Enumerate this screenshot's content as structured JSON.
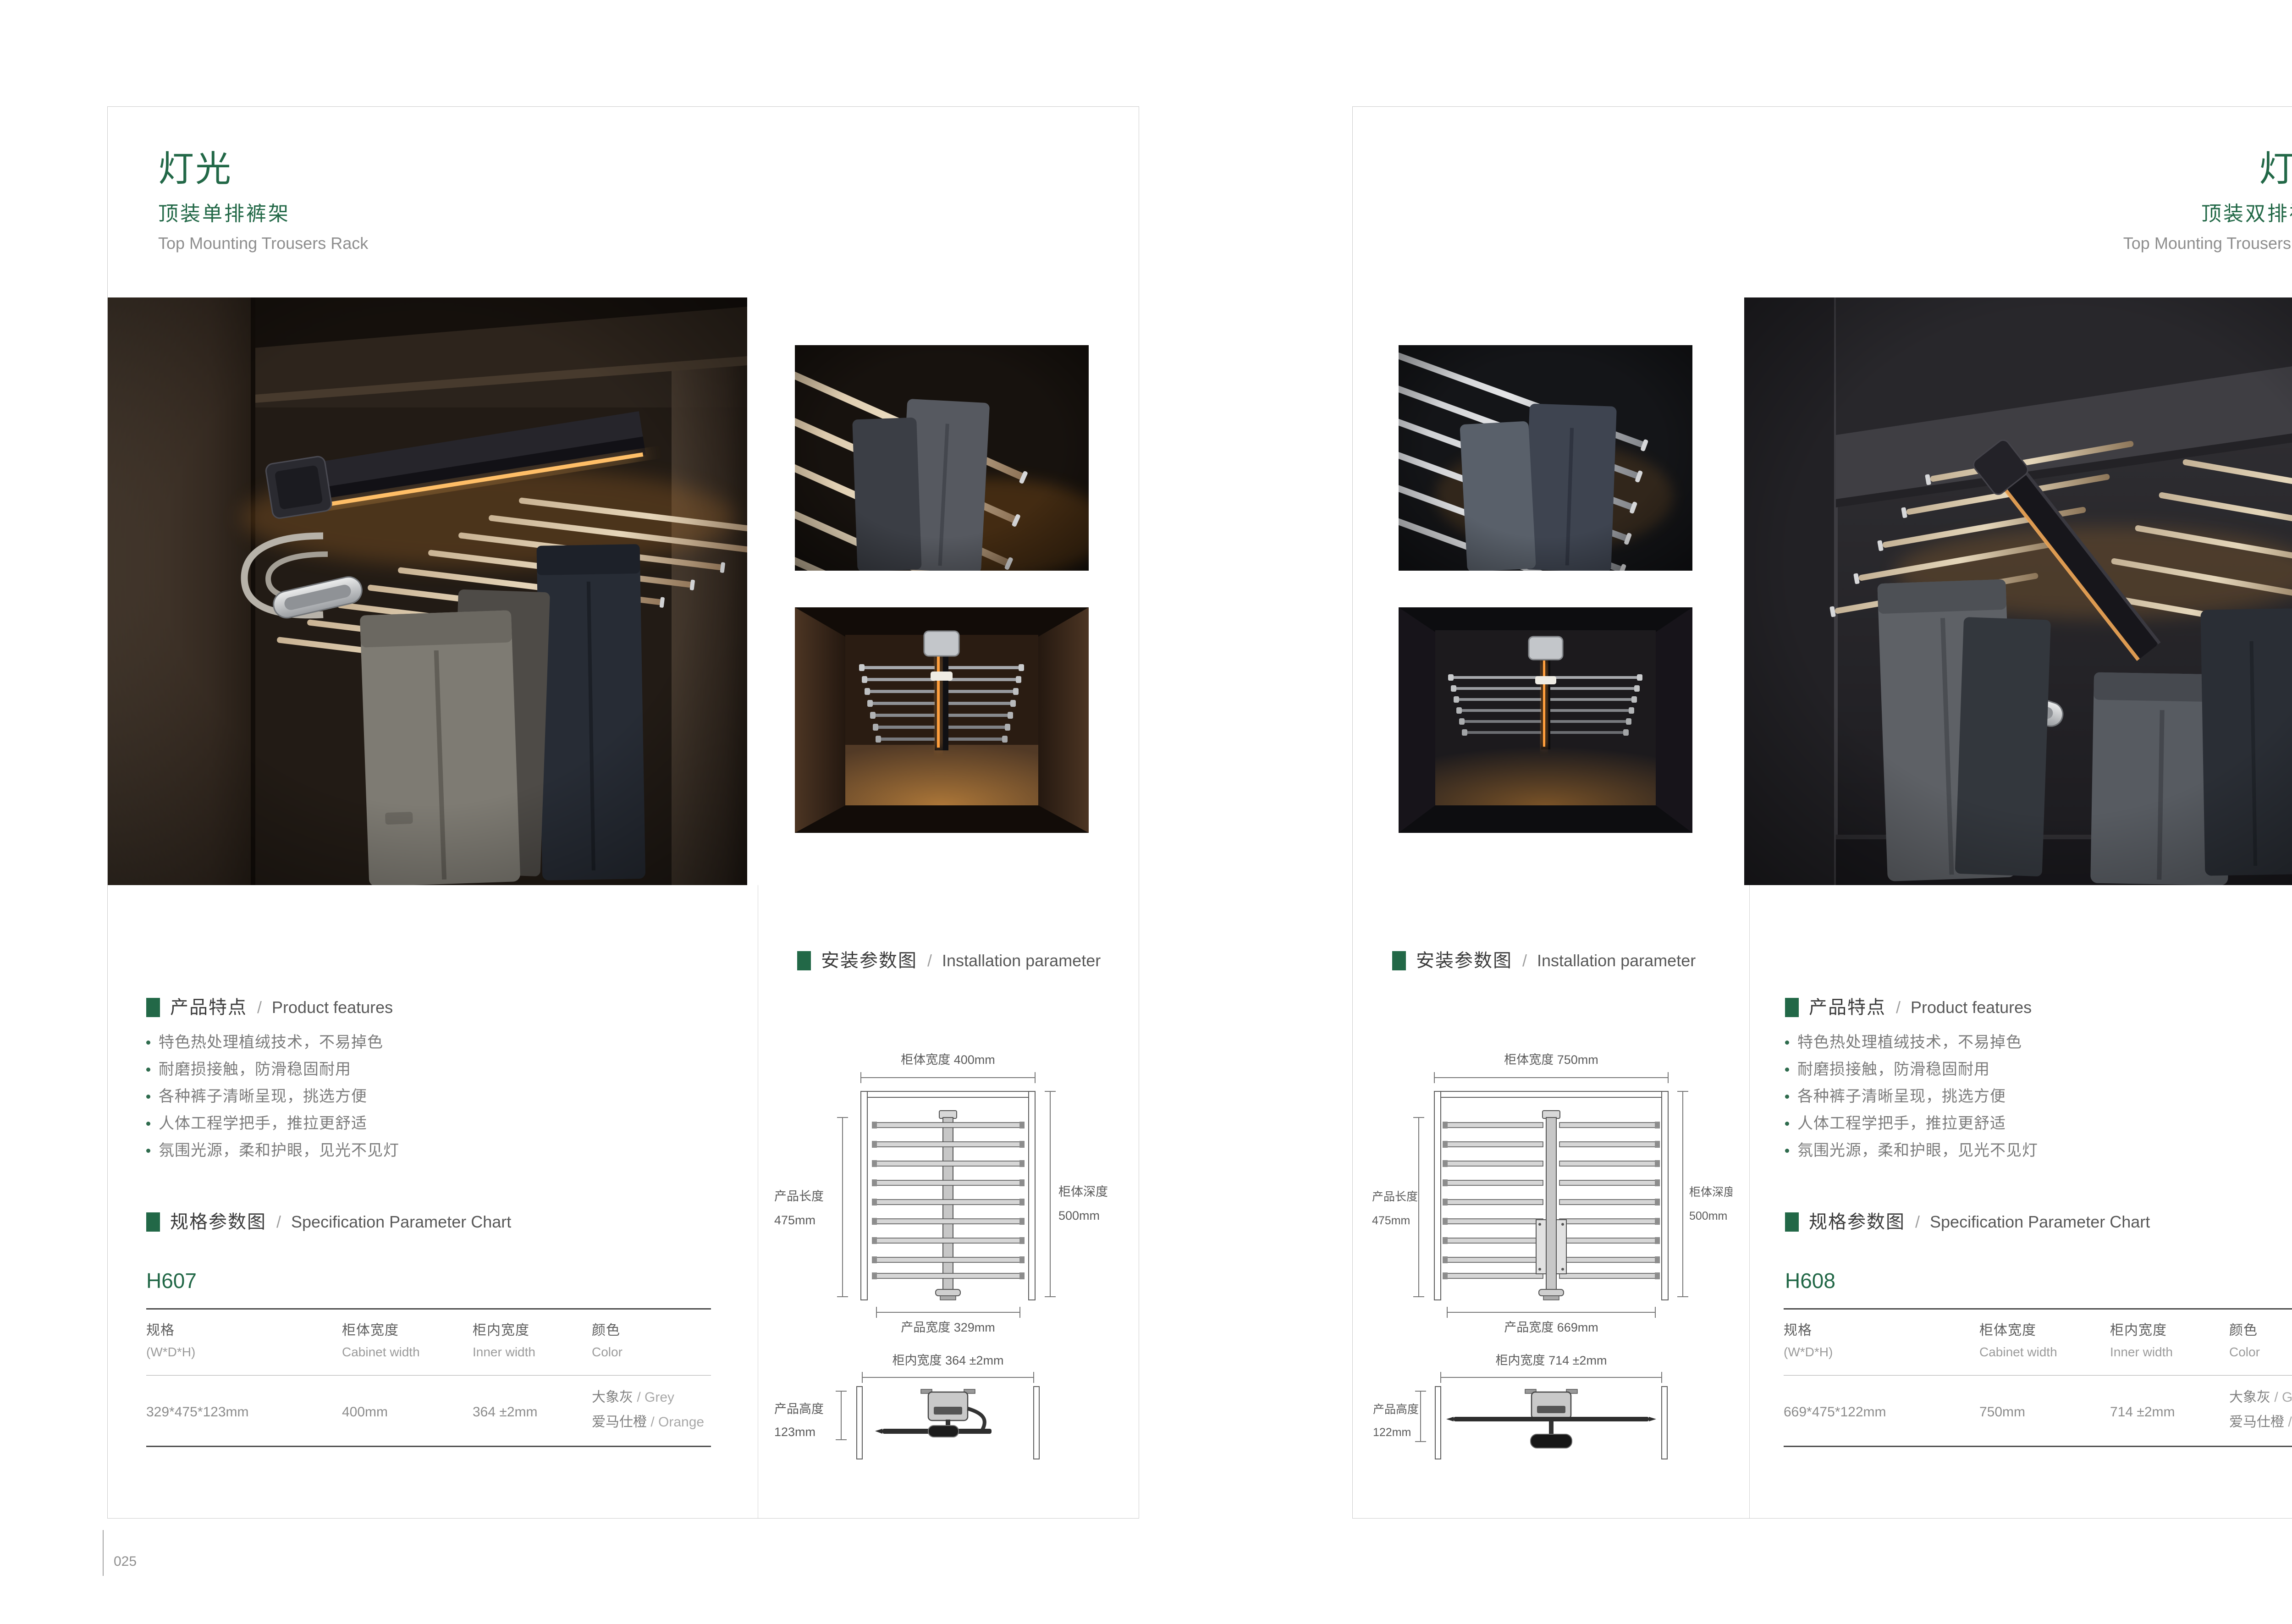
{
  "colors": {
    "accent_green": "#226847",
    "subtitle_gray": "#8e8e8e",
    "table_rule_dark": "#4a4a4a",
    "body_text_gray": "#7c7c7c"
  },
  "left_page": {
    "page_number": "025",
    "header": {
      "title": "灯光",
      "subtitle_cn": "顶装单排裤架",
      "subtitle_en": "Top Mounting Trousers Rack"
    },
    "features": {
      "cn": "产品特点",
      "sep": "/",
      "en": "Product features",
      "items": [
        "特色热处理植绒技术，不易掉色",
        "耐磨损接触，防滑稳固耐用",
        "各种裤子清晰呈现，挑选方便",
        "人体工程学把手，推拉更舒适",
        "氛围光源，柔和护眼，见光不见灯"
      ]
    },
    "installation": {
      "cn": "安装参数图",
      "sep": "/",
      "en": "Installation parameter",
      "top": {
        "cabinet_width": "柜体宽度 400mm",
        "product_length_1": "产品长度",
        "product_length_2": "475mm",
        "cabinet_depth_1": "柜体深度",
        "cabinet_depth_2": "500mm",
        "product_width": "产品宽度 329mm"
      },
      "bottom": {
        "inner_width": "柜内宽度 364 ±2mm",
        "product_height_1": "产品高度",
        "product_height_2": "123mm"
      }
    },
    "spec": {
      "cn": "规格参数图",
      "sep": "/",
      "en": "Specification Parameter Chart",
      "model": "H607",
      "col1_cn": "规格",
      "col1_en": "(W*D*H)",
      "col2_cn": "柜体宽度",
      "col2_en": "Cabinet width",
      "col3_cn": "柜内宽度",
      "col3_en": "Inner width",
      "col4_cn": "颜色",
      "col4_en": "Color",
      "val_size": "329*475*123mm",
      "val_cabinet_width": "400mm",
      "val_inner_width": "364 ±2mm",
      "color1_cn": "大象灰",
      "color1_en": "/ Grey",
      "color2_cn": "爱马仕橙",
      "color2_en": "/ Orange"
    }
  },
  "right_page": {
    "page_number": "026",
    "header": {
      "title": "灯光",
      "subtitle_cn": "顶装双排裤架",
      "subtitle_en": "Top Mounting Trousers Rack"
    },
    "features": {
      "cn": "产品特点",
      "sep": "/",
      "en": "Product features",
      "items": [
        "特色热处理植绒技术，不易掉色",
        "耐磨损接触，防滑稳固耐用",
        "各种裤子清晰呈现，挑选方便",
        "人体工程学把手，推拉更舒适",
        "氛围光源，柔和护眼，见光不见灯"
      ]
    },
    "installation": {
      "cn": "安装参数图",
      "sep": "/",
      "en": "Installation parameter",
      "top": {
        "cabinet_width": "柜体宽度 750mm",
        "product_length_1": "产品长度",
        "product_length_2": "475mm",
        "cabinet_depth_1": "柜体深度",
        "cabinet_depth_2": "500mm",
        "product_width": "产品宽度 669mm"
      },
      "bottom": {
        "inner_width": "柜内宽度 714 ±2mm",
        "product_height_1": "产品高度",
        "product_height_2": "122mm"
      }
    },
    "spec": {
      "cn": "规格参数图",
      "sep": "/",
      "en": "Specification Parameter Chart",
      "model": "H608",
      "col1_cn": "规格",
      "col1_en": "(W*D*H)",
      "col2_cn": "柜体宽度",
      "col2_en": "Cabinet width",
      "col3_cn": "柜内宽度",
      "col3_en": "Inner width",
      "col4_cn": "颜色",
      "col4_en": "Color",
      "val_size": "669*475*122mm",
      "val_cabinet_width": "750mm",
      "val_inner_width": "714 ±2mm",
      "color1_cn": "大象灰",
      "color1_en": "/ Grey",
      "color2_cn": "爱马仕橙",
      "color2_en": "/ Orange"
    }
  }
}
